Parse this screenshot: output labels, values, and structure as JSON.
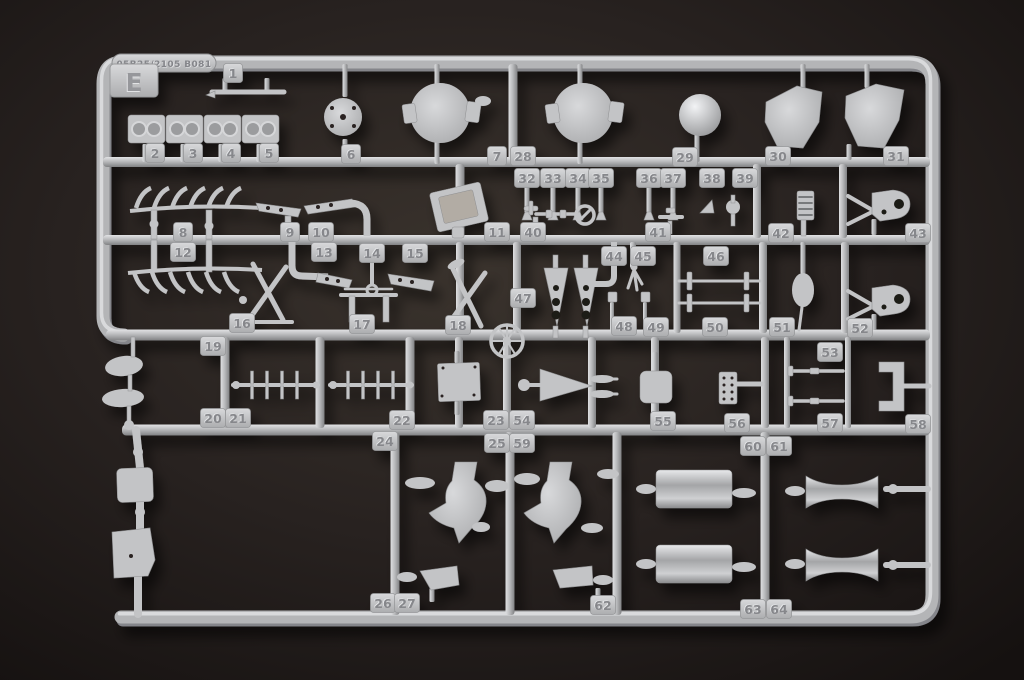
{
  "photo": {
    "subject": "plastic model kit sprue photographed on dark backdrop",
    "mold_code": "05B25/2105 B081",
    "sprue_letter": "E",
    "colors": {
      "background": "#241e1a",
      "plastic": "#bcbdbf",
      "plastic_highlight": "#e3e4e6",
      "plastic_shadow": "#87888a",
      "hole_dark": "#2a2420"
    },
    "part_tags": [
      [
        1,
        233,
        73
      ],
      [
        2,
        155,
        153
      ],
      [
        3,
        193,
        153
      ],
      [
        4,
        231,
        153
      ],
      [
        5,
        269,
        153
      ],
      [
        6,
        351,
        154
      ],
      [
        7,
        497,
        156
      ],
      [
        28,
        523,
        156
      ],
      [
        29,
        685,
        157
      ],
      [
        30,
        778,
        156
      ],
      [
        31,
        896,
        156
      ],
      [
        32,
        527,
        178
      ],
      [
        33,
        553,
        178
      ],
      [
        34,
        578,
        178
      ],
      [
        35,
        601,
        178
      ],
      [
        36,
        649,
        178
      ],
      [
        37,
        673,
        178
      ],
      [
        38,
        712,
        178
      ],
      [
        39,
        745,
        178
      ],
      [
        8,
        183,
        232
      ],
      [
        9,
        290,
        232
      ],
      [
        10,
        321,
        232
      ],
      [
        11,
        497,
        232
      ],
      [
        40,
        533,
        232
      ],
      [
        41,
        658,
        232
      ],
      [
        42,
        781,
        233
      ],
      [
        43,
        918,
        233
      ],
      [
        12,
        183,
        252
      ],
      [
        13,
        324,
        252
      ],
      [
        14,
        372,
        253
      ],
      [
        15,
        415,
        253
      ],
      [
        44,
        614,
        256
      ],
      [
        45,
        643,
        256
      ],
      [
        46,
        716,
        256
      ],
      [
        47,
        523,
        298
      ],
      [
        16,
        242,
        323
      ],
      [
        17,
        362,
        324
      ],
      [
        18,
        458,
        325
      ],
      [
        48,
        624,
        326
      ],
      [
        49,
        656,
        327
      ],
      [
        50,
        715,
        327
      ],
      [
        51,
        782,
        327
      ],
      [
        52,
        860,
        328
      ],
      [
        19,
        213,
        346
      ],
      [
        53,
        830,
        352
      ],
      [
        20,
        213,
        418
      ],
      [
        21,
        238,
        418
      ],
      [
        22,
        402,
        420
      ],
      [
        23,
        496,
        420
      ],
      [
        54,
        522,
        420
      ],
      [
        55,
        663,
        421
      ],
      [
        56,
        737,
        423
      ],
      [
        57,
        830,
        423
      ],
      [
        58,
        918,
        424
      ],
      [
        24,
        385,
        441
      ],
      [
        25,
        497,
        443
      ],
      [
        59,
        522,
        443
      ],
      [
        60,
        753,
        446
      ],
      [
        61,
        779,
        446
      ],
      [
        26,
        383,
        603
      ],
      [
        27,
        407,
        603
      ],
      [
        62,
        603,
        605
      ],
      [
        63,
        753,
        609
      ],
      [
        64,
        779,
        609
      ]
    ]
  }
}
